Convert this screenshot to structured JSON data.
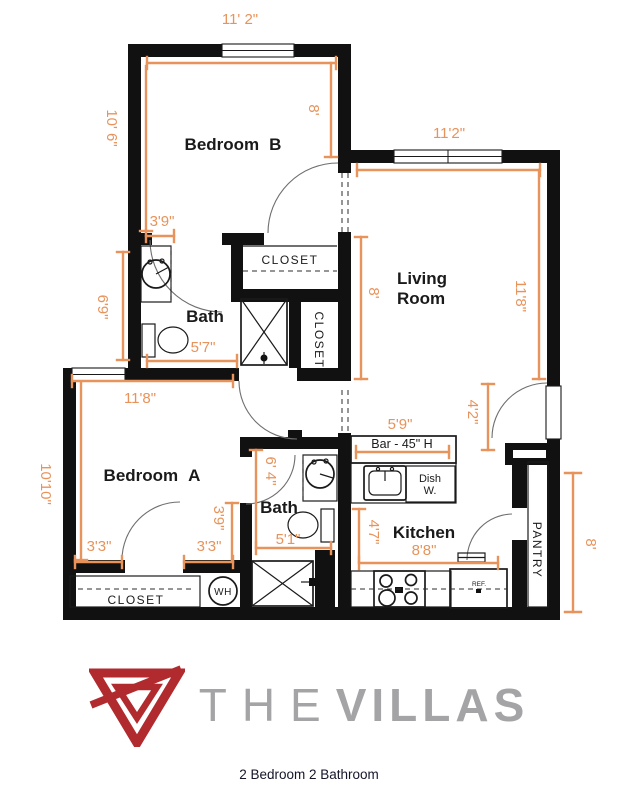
{
  "theme": {
    "accent": "#E8935B",
    "wall": "#111111",
    "ink": "#1A1A1A",
    "line": "#6E6E6E",
    "brand_red": "#B02A2E",
    "brand_gray": "#A4A4A6",
    "caption": "#15152A"
  },
  "page": {
    "caption": "2 Bedroom 2 Bathroom"
  },
  "brand": {
    "the": "THE",
    "villas": "VILLAS"
  },
  "plan": {
    "rooms": {
      "bedroom_b": {
        "name": "Bedroom",
        "unit": "B"
      },
      "living": {
        "line1": "Living",
        "line2": "Room"
      },
      "bath_b": {
        "name": "Bath"
      },
      "bedroom_a": {
        "name": "Bedroom",
        "unit": "A"
      },
      "bath_a": {
        "name": "Bath"
      },
      "kitchen": {
        "name": "Kitchen"
      }
    },
    "fixtures": {
      "closet_top": "CLOSET",
      "closet_linen": "CLOSET",
      "closet_bottom": "CLOSET",
      "pantry": "PANTRY",
      "bar": "Bar - 45\" H",
      "dish_1": "Dish",
      "dish_2": "W.",
      "ref": "REF.",
      "wh": "WH"
    },
    "dims": {
      "bb_top": "11' 2\"",
      "bb_left": "10' 6\"",
      "bb_right": "8'",
      "lr_top": "11'2\"",
      "lr_right": "11'8\"",
      "lr_left": "8'",
      "bathb_w": "3'9\"",
      "bathb_h": "6'9\"",
      "bathb_b": "5'7\"",
      "ba_top": "11'8\"",
      "ba_left": "10'10\"",
      "ba_b1": "3'3\"",
      "ba_b2": "3'3\"",
      "ba_v": "3'9\"",
      "batha_h": "6' 4\"",
      "batha_w": "5'1\"",
      "k_bar": "5'9\"",
      "k_h": "4'7\"",
      "k_w": "8'8\"",
      "entry": "4'2\"",
      "right": "8'"
    }
  }
}
